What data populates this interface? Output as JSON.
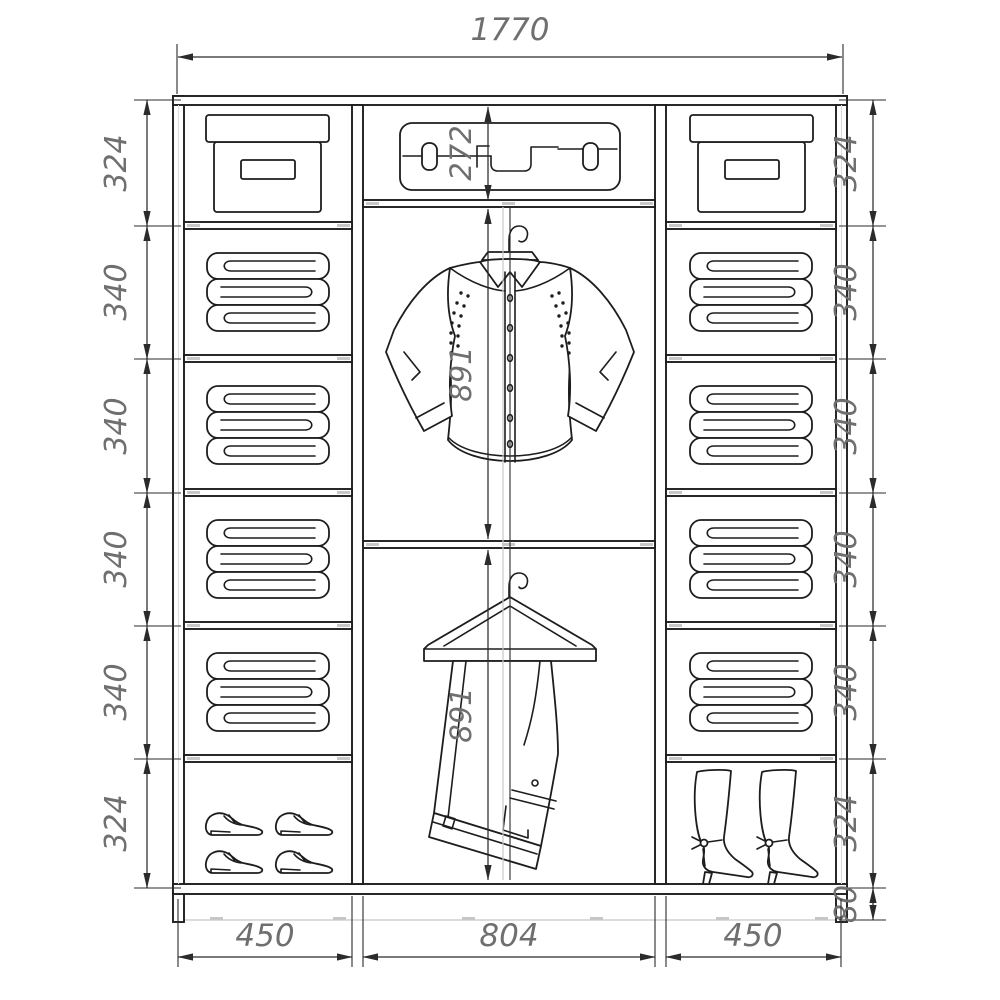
{
  "dims": {
    "total_width": "1770",
    "left": [
      "324",
      "340",
      "340",
      "340",
      "340",
      "324"
    ],
    "right": [
      "324",
      "340",
      "340",
      "340",
      "340",
      "324"
    ],
    "plinth": "80",
    "bottom": [
      "450",
      "804",
      "450"
    ],
    "middle_top": "272",
    "middle_upper": "891",
    "middle_lower": "891"
  },
  "sections": {
    "left_column": [
      "storage-box",
      "folded-linen",
      "folded-linen",
      "folded-linen",
      "folded-linen",
      "shoes"
    ],
    "middle_column": [
      "suitcase-shelf",
      "shirt-on-hanger",
      "trousers-on-hanger"
    ],
    "right_column": [
      "storage-box",
      "folded-linen",
      "folded-linen",
      "folded-linen",
      "folded-linen",
      "boots"
    ]
  },
  "colors": {
    "line": "#1d1d1d",
    "dim_line": "#2b2b2b",
    "dim_text": "#6f6f6f",
    "construction": "#c7c7c7",
    "background": "#ffffff"
  }
}
